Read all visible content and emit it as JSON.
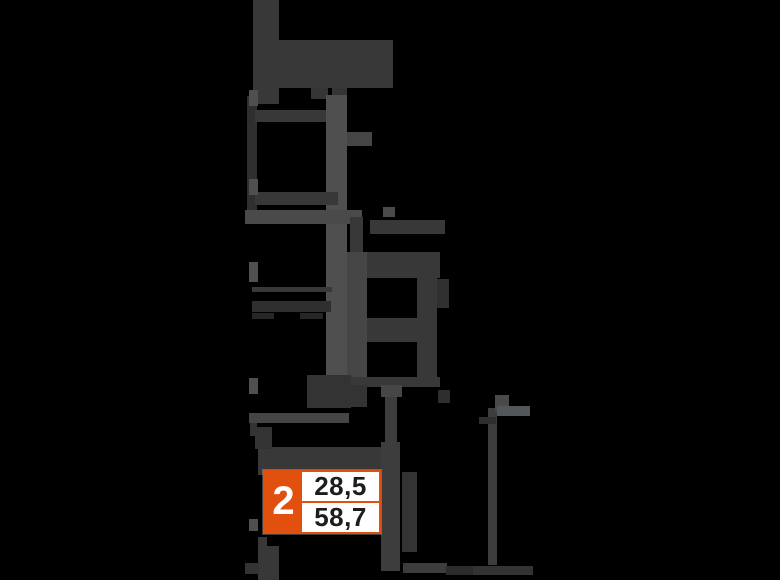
{
  "canvas": {
    "width": 780,
    "height": 580,
    "background_color": "#000000"
  },
  "badge": {
    "rooms": "2",
    "area_top": "28,5",
    "area_bottom": "58,7",
    "accent_color": "#e1500f",
    "text_color": "#1d1d1d",
    "background_color": "#ffffff"
  },
  "plan": {
    "wall_color": "#383838",
    "wall_color_light": "#4f4f4f",
    "shapes": [
      {
        "n": "wall-top-vertical",
        "x": 253,
        "y": 0,
        "w": 26,
        "h": 104,
        "c": "#383838"
      },
      {
        "n": "wall-top-rect",
        "x": 279,
        "y": 40,
        "w": 114,
        "h": 48,
        "c": "#383838"
      },
      {
        "n": "wall-tab-a",
        "x": 311,
        "y": 88,
        "w": 17,
        "h": 11,
        "c": "#353535"
      },
      {
        "n": "wall-tab-b",
        "x": 332,
        "y": 88,
        "w": 15,
        "h": 16,
        "c": "#353535"
      },
      {
        "n": "room1-left-wall",
        "x": 247,
        "y": 96,
        "w": 10,
        "h": 126,
        "c": "#2f2f2f"
      },
      {
        "n": "room1-top-wall",
        "x": 255,
        "y": 110,
        "w": 75,
        "h": 12,
        "c": "#383838"
      },
      {
        "n": "corridor-wall-vertical",
        "x": 326,
        "y": 95,
        "w": 21,
        "h": 290,
        "c": "#4f4f4f"
      },
      {
        "n": "room1-right-bump",
        "x": 347,
        "y": 132,
        "w": 25,
        "h": 14,
        "c": "#454545"
      },
      {
        "n": "room1-bottom-wall",
        "x": 255,
        "y": 192,
        "w": 83,
        "h": 13,
        "c": "#383838"
      },
      {
        "n": "hall-band",
        "x": 245,
        "y": 210,
        "w": 117,
        "h": 14,
        "c": "#4a4a4a"
      },
      {
        "n": "balcony-line-1",
        "x": 252,
        "y": 287,
        "w": 80,
        "h": 5,
        "c": "#383838"
      },
      {
        "n": "balcony-line-2",
        "x": 252,
        "y": 301,
        "w": 79,
        "h": 11,
        "c": "#2f2f2f"
      },
      {
        "n": "balcony-dash-1",
        "x": 252,
        "y": 313,
        "w": 22,
        "h": 6,
        "c": "#262626"
      },
      {
        "n": "balcony-dash-2",
        "x": 300,
        "y": 313,
        "w": 23,
        "h": 6,
        "c": "#262626"
      },
      {
        "n": "wall-stub-vertical",
        "x": 350,
        "y": 217,
        "w": 13,
        "h": 40,
        "c": "#383838"
      },
      {
        "n": "room2-top-wall",
        "x": 370,
        "y": 220,
        "w": 75,
        "h": 14,
        "c": "#383838"
      },
      {
        "n": "room2-top-band",
        "x": 347,
        "y": 252,
        "w": 93,
        "h": 26,
        "c": "#383838"
      },
      {
        "n": "room2-left-wall",
        "x": 347,
        "y": 252,
        "w": 20,
        "h": 130,
        "c": "#464646"
      },
      {
        "n": "room2-right-wall",
        "x": 417,
        "y": 252,
        "w": 20,
        "h": 125,
        "c": "#383838"
      },
      {
        "n": "room2-mid-band",
        "x": 367,
        "y": 318,
        "w": 50,
        "h": 24,
        "c": "#383838"
      },
      {
        "n": "room2-right-protrusion",
        "x": 437,
        "y": 279,
        "w": 12,
        "h": 29,
        "c": "#303030"
      },
      {
        "n": "wall-dot",
        "x": 383,
        "y": 207,
        "w": 12,
        "h": 10,
        "c": "#4a4a4a"
      },
      {
        "n": "bottom-wall-horizontal",
        "x": 328,
        "y": 377,
        "w": 112,
        "h": 10,
        "c": "#383838"
      },
      {
        "n": "wall-chunk-lower",
        "x": 307,
        "y": 375,
        "w": 44,
        "h": 33,
        "c": "#333333"
      },
      {
        "n": "wall-stub-below",
        "x": 350,
        "y": 385,
        "w": 17,
        "h": 22,
        "c": "#333333"
      },
      {
        "n": "ledge-bar",
        "x": 249,
        "y": 413,
        "w": 100,
        "h": 10,
        "c": "#454545"
      },
      {
        "n": "ledge-tick",
        "x": 250,
        "y": 423,
        "w": 7,
        "h": 13,
        "c": "#333333"
      },
      {
        "n": "band-above-badge",
        "x": 258,
        "y": 447,
        "w": 126,
        "h": 28,
        "c": "#383838"
      },
      {
        "n": "stub-above-band",
        "x": 255,
        "y": 427,
        "w": 17,
        "h": 22,
        "c": "#333333"
      },
      {
        "n": "bar-below-badge-a",
        "x": 258,
        "y": 537,
        "w": 9,
        "h": 43,
        "c": "#383838"
      },
      {
        "n": "bar-below-badge-b",
        "x": 258,
        "y": 546,
        "w": 21,
        "h": 34,
        "c": "#383838"
      },
      {
        "n": "entry-vbar-top",
        "x": 385,
        "y": 385,
        "w": 12,
        "h": 57,
        "c": "#3d3d3d"
      },
      {
        "n": "entry-vbar-cap",
        "x": 381,
        "y": 385,
        "w": 21,
        "h": 12,
        "c": "#464646"
      },
      {
        "n": "entry-vbar-main",
        "x": 381,
        "y": 442,
        "w": 19,
        "h": 129,
        "c": "#3d3d3d"
      },
      {
        "n": "block-right-of-badge",
        "x": 402,
        "y": 472,
        "w": 15,
        "h": 80,
        "c": "#333333"
      },
      {
        "n": "right-strip-vertical",
        "x": 488,
        "y": 408,
        "w": 9,
        "h": 157,
        "c": "#3d3d3d"
      },
      {
        "n": "flag-vertical",
        "x": 495,
        "y": 395,
        "w": 14,
        "h": 16,
        "c": "#4a4a4a"
      },
      {
        "n": "flag-horizontal",
        "x": 497,
        "y": 406,
        "w": 33,
        "h": 10,
        "c": "#54575a"
      },
      {
        "n": "cross-piece",
        "x": 479,
        "y": 417,
        "w": 17,
        "h": 7,
        "c": "#2e2e2e"
      },
      {
        "n": "small-piece-right",
        "x": 438,
        "y": 390,
        "w": 12,
        "h": 13,
        "c": "#2e2e2e"
      },
      {
        "n": "bottom-bar-1",
        "x": 403,
        "y": 563,
        "w": 44,
        "h": 10,
        "c": "#3d3d3d"
      },
      {
        "n": "bottom-bar-2",
        "x": 446,
        "y": 566,
        "w": 27,
        "h": 9,
        "c": "#2b2b2b"
      },
      {
        "n": "bottom-bar-3",
        "x": 473,
        "y": 566,
        "w": 60,
        "h": 9,
        "c": "#333333"
      },
      {
        "n": "window-tick-1",
        "x": 249,
        "y": 90,
        "w": 9,
        "h": 16,
        "c": "#4f4f4f"
      },
      {
        "n": "window-tick-2",
        "x": 249,
        "y": 179,
        "w": 9,
        "h": 16,
        "c": "#4f4f4f"
      },
      {
        "n": "window-tick-3",
        "x": 249,
        "y": 262,
        "w": 9,
        "h": 20,
        "c": "#4f4f4f"
      },
      {
        "n": "window-tick-4",
        "x": 249,
        "y": 378,
        "w": 9,
        "h": 16,
        "c": "#4f4f4f"
      },
      {
        "n": "window-tick-5",
        "x": 249,
        "y": 519,
        "w": 9,
        "h": 12,
        "c": "#4f4f4f"
      },
      {
        "n": "corner-piece-bottom-left",
        "x": 245,
        "y": 563,
        "w": 14,
        "h": 11,
        "c": "#333333"
      }
    ]
  }
}
